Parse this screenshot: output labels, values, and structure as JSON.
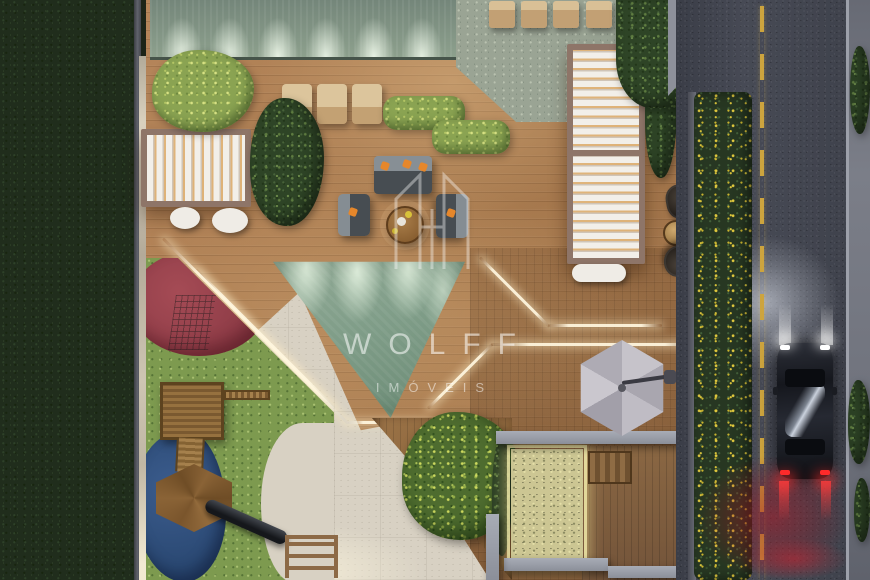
{
  "image": {
    "title": "Aerial night-time 3D architectural rendering",
    "description": "Top-down view of a residential condominium leisure terrace at dusk: wooden deck with LED seams, louvered pergolas, lounge furniture, triangular plunge pool, children's playground, stone spa pad with parasol, flower hedge and adjacent street with a passing car."
  },
  "watermark": {
    "brand": "WOLFF",
    "subtitle": "IMÓVEIS",
    "logo_icon": "building-monogram-icon",
    "color": "rgba(255,255,255,0.5)"
  },
  "palette": {
    "deck_wood": "#ab7f53",
    "pool_water": "#84a08c",
    "neighbor_lawn": "#202d1c",
    "playground_turf": "#7d9a4f",
    "playground_red": "#9a4450",
    "playground_blue": "#2f4f7c",
    "pavement": "#d8d1c3",
    "asphalt": "#42454f",
    "road_marking_yellow": "#cda43e",
    "pergola_white": "#f0ede7",
    "pergola_frame": "#8e7568",
    "spa_stone": "#ccc693",
    "umbrella_gray": "#b7b4bc",
    "hedge_green": "#273722",
    "flower_yellow": "#dcc63c",
    "headlight_white": "#ffffff",
    "taillight_red": "#ff2a2a",
    "led_warm_white": "#fff6de",
    "accent_pillow_orange": "#e6872b"
  },
  "scene": {
    "areas": [
      {
        "name": "neighbor-lawn",
        "label": "Dark lawn strip of neighboring lot"
      },
      {
        "name": "green-wall-water-feature",
        "label": "Uplit green stone feature wall with six wall-washer lights"
      },
      {
        "name": "stone-patio",
        "label": "Green stone patio with four tan loungers"
      },
      {
        "name": "wood-deck",
        "label": "Main hardwood deck"
      },
      {
        "name": "pergola-square",
        "label": "Square pergola with white louvers and warm underlight"
      },
      {
        "name": "pergola-long",
        "label": "Long two-module pergola with white louvers"
      },
      {
        "name": "sun-loungers",
        "label": "Three tan sun loungers"
      },
      {
        "name": "lounge-set",
        "label": "Gray sofa and two armchairs with orange pillows around round wood coffee table"
      },
      {
        "name": "plunge-pool",
        "label": "Triangular green plunge pool with scalloped underwater lights"
      },
      {
        "name": "led-seams",
        "label": "Warm LED light strips recessed in deck joints"
      },
      {
        "name": "playground",
        "label": "Playground with green turf, red circle and blue organic mat"
      },
      {
        "name": "play-structures",
        "label": "Wooden play tower, monkey bars, bridge, hexagonal deck and dark slide"
      },
      {
        "name": "concrete-pavement",
        "label": "Light concrete paving band"
      },
      {
        "name": "garden-tree",
        "label": "Large garden tree in triangular wood planter"
      },
      {
        "name": "spa-stone-pad",
        "label": "Glowing speckled stone spa pad framed by concrete walls"
      },
      {
        "name": "timber-bench",
        "label": "Timber bench beside spa pad"
      },
      {
        "name": "parasol",
        "label": "Gray hexagonal cantilever parasol"
      },
      {
        "name": "wicker-seating",
        "label": "Two dark wicker chairs with round side table"
      },
      {
        "name": "flower-hedge",
        "label": "Property hedge dotted with yellow flowers"
      },
      {
        "name": "street",
        "label": "Night street with dashed yellow center line"
      },
      {
        "name": "car",
        "label": "Dark sedan driving with headlights and red taillights"
      },
      {
        "name": "sidewalk",
        "label": "Far sidewalk with small bushes"
      }
    ]
  }
}
